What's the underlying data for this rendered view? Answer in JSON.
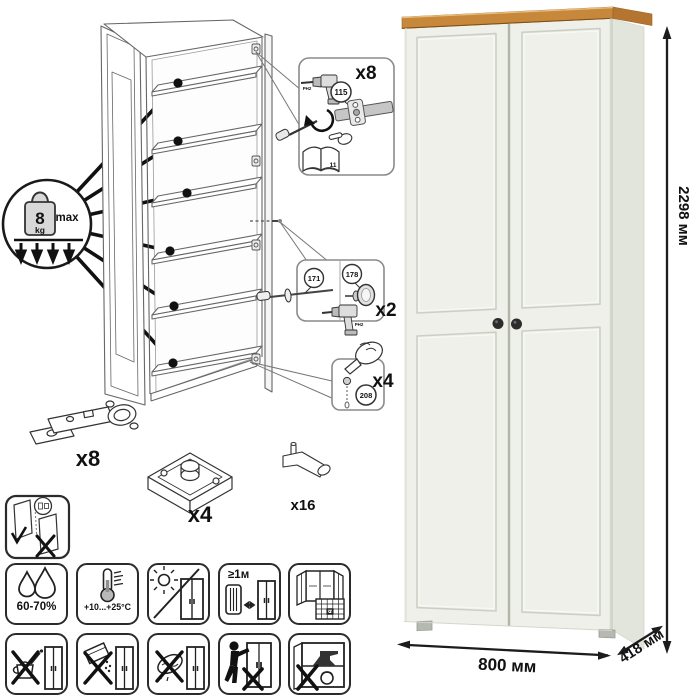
{
  "diagram": {
    "weight": {
      "value": "8",
      "unit": "kg",
      "max": "max"
    },
    "hinge_mount": {
      "count": "x8",
      "part": "115",
      "bit": "PH2",
      "page": "11"
    },
    "knob": {
      "screw_part": "171",
      "knob_part": "178",
      "count": "x2",
      "bit": "PH2"
    },
    "dowel": {
      "part": "208",
      "count": "x4"
    },
    "hardware": {
      "hinge_count": "x8",
      "foot_count": "x4",
      "pin_count": "x16"
    }
  },
  "care": {
    "humidity": "60-70%",
    "temperature": "+10...+25°C",
    "distance": "≥1м",
    "calendar_day": "21"
  },
  "dimensions": {
    "height": "2298 мм",
    "width": "800 мм",
    "depth": "418 мм"
  },
  "colors": {
    "wood_top": "#c8883c",
    "body": "#eef0e9",
    "knob": "#2d2d2d",
    "line": "#1a1a1a"
  }
}
